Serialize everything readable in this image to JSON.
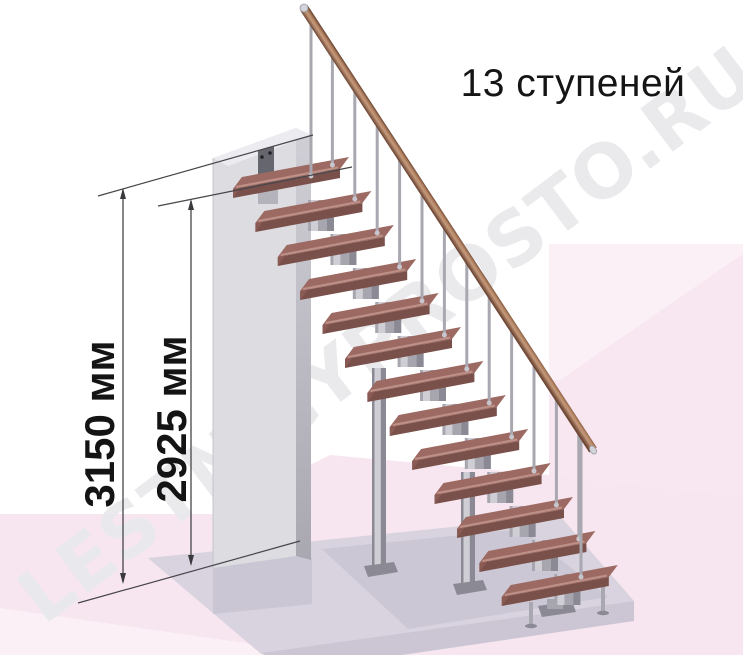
{
  "stairs": {
    "label": "13 ступеней",
    "step_count": 13
  },
  "dimensions": [
    {
      "id": "total-height",
      "label": "3150 мм",
      "value_mm": 3150
    },
    {
      "id": "height-to-top-step",
      "label": "2925 мм",
      "value_mm": 2925
    }
  ],
  "watermark": {
    "text": "LESTNICYPROSTO.RU"
  },
  "colors": {
    "dimension_line": "#46464a",
    "arrow": "#3a3a3e",
    "tread_top": "#9d6a63",
    "tread_front": "#7a504b",
    "tread_end": "#8a5a54",
    "tread_highlight": "#bd9187",
    "metal_light": "#d0ced5",
    "metal_mid": "#a7a5ae",
    "metal_dark": "#8b8993",
    "baluster": "#a9a7b0",
    "joint": "#c8c6cd",
    "rail_light": "#c59a7c",
    "rail_mid": "#b0805f",
    "rail_dark": "#6f4836",
    "rail_darker": "#5e3a2a",
    "cap_silver": "#d3d3da",
    "cap_edge": "#9a9aa2",
    "wall_front": "#dcdce1",
    "wall_side_top": "#d0cfd6",
    "wall_side_bottom": "#a9a8b1",
    "wall_top": "#ececf0",
    "plate": "#66666e",
    "bolt": "#222226",
    "bracket": "#b4b2ba",
    "slab_top": "#d8d3df",
    "slab_front": "#ccc6d4",
    "slab_shadow": "#c5c0ce",
    "wall_shadow": "#c8c3d1",
    "pink_wall": "#f8e7f0",
    "pink_wall_light": "#fbf0f6",
    "pink_floor": "#f7e6ef",
    "pink_floor_light": "#fbf0f6",
    "background": "#ffffff"
  }
}
